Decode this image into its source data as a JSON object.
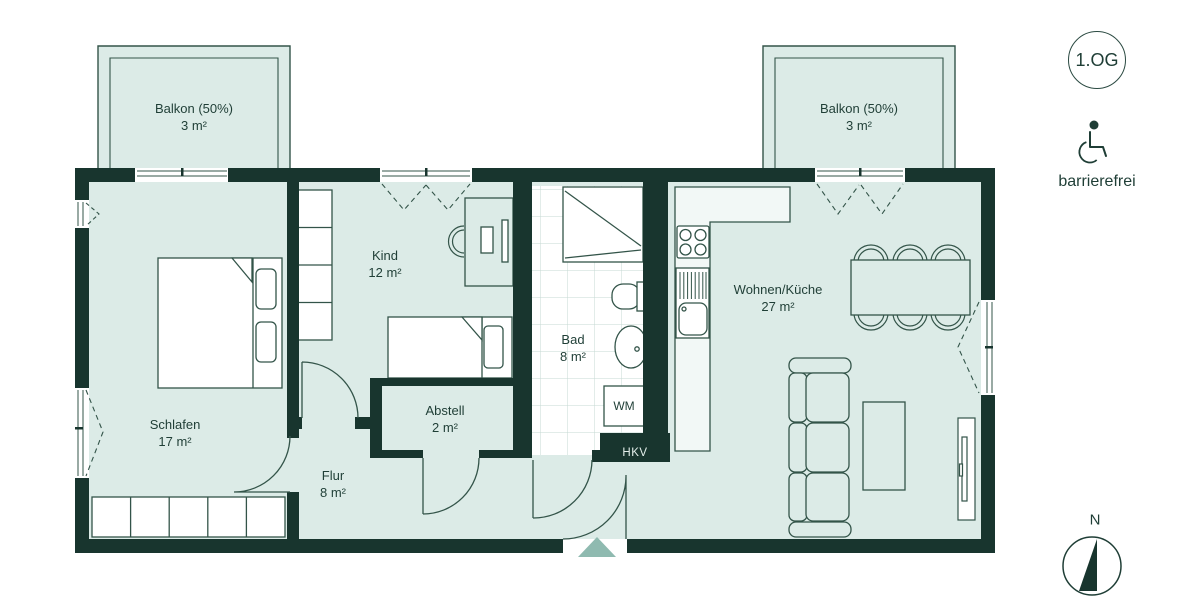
{
  "floorplan": {
    "floor_badge": "1.OG",
    "accessibility": "barrierefrei",
    "compass": "N",
    "rooms": [
      {
        "name": "Balkon (50%)",
        "area": "3 m²"
      },
      {
        "name": "Balkon (50%)",
        "area": "3 m²"
      },
      {
        "name": "Schlafen",
        "area": "17 m²"
      },
      {
        "name": "Kind",
        "area": "12 m²"
      },
      {
        "name": "Bad",
        "area": "8 m²"
      },
      {
        "name": "Abstell",
        "area": "2 m²"
      },
      {
        "name": "Flur",
        "area": "8 m²"
      },
      {
        "name": "Wohnen/Küche",
        "area": "27 m²"
      }
    ],
    "appliances": {
      "washing_machine": "WM",
      "heating_distributor": "HKV"
    },
    "colors": {
      "wall": "#18352e",
      "floor": "#dcebe7",
      "outline": "#335449",
      "tile": "#c5d9d3",
      "entrance_arrow": "#8fbab0"
    }
  }
}
